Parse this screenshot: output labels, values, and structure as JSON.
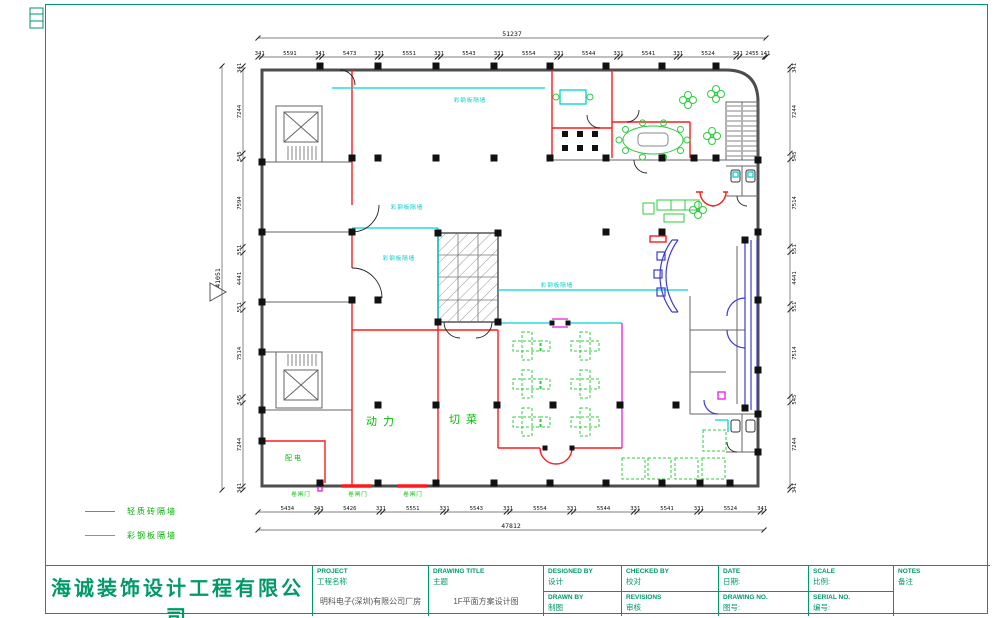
{
  "colors": {
    "sheet_border": "#009a66",
    "wall_gray": "#4d4d4d",
    "brick_wall_red": "#ff1a1a",
    "steel_wall_cyan": "#00d2d2",
    "furniture_green": "#00b400",
    "entrance_blue": "#3b3bd6",
    "accent_magenta": "#e61ae6",
    "company_green": "#009a66"
  },
  "legend": {
    "items": [
      {
        "label": "轻质砖隔墙",
        "color": "#ff1a1a"
      },
      {
        "label": "彩钢板隔墙",
        "color": "#00d2d2"
      }
    ]
  },
  "title_block": {
    "company_cn": "海诚装饰设计工程有限公司",
    "company_en": "SHENZHENSHI HAI CHENG DECORATION DESIGNENGINEERING CO.,LTD.",
    "fields": {
      "project": {
        "label_en": "PROJECT",
        "label_cn": "工程名称",
        "value": "明科电子(深圳)有限公司厂房"
      },
      "drawing_title": {
        "label_en": "DRAWING TITLE",
        "label_cn": "主题",
        "value": "1F平面方案设计图"
      },
      "designed_by": {
        "label_en": "DESIGNED BY",
        "label_cn": "设计",
        "value": ""
      },
      "drawn_by": {
        "label_en": "DRAWN BY",
        "label_cn": "制图",
        "value": ""
      },
      "checked_by": {
        "label_en": "CHECKED BY",
        "label_cn": "校对",
        "value": ""
      },
      "revisions": {
        "label_en": "REVISIONS",
        "label_cn": "审核",
        "value": ""
      },
      "date": {
        "label_en": "DATE",
        "label_cn": "日期:",
        "value": ""
      },
      "drawing_no": {
        "label_en": "DRAWING NO.",
        "label_cn": "图号:",
        "value": ""
      },
      "scale": {
        "label_en": "SCALE",
        "label_cn": "比例:",
        "value": ""
      },
      "serial_no": {
        "label_en": "SERIAL NO.",
        "label_cn": "编号:",
        "value": ""
      },
      "notes": {
        "label_en": "NOTES",
        "label_cn": "备注",
        "value": ""
      }
    }
  },
  "dim_rows": [
    {
      "name": "top-total",
      "orient": "h",
      "x1": 258,
      "x2": 766,
      "y": 38,
      "cls": "big",
      "labels": [
        "51237"
      ]
    },
    {
      "name": "top-segments",
      "orient": "h",
      "x1": 258,
      "x2": 766,
      "y": 57,
      "labels": [
        "341",
        "5591",
        "341",
        "5473",
        "331",
        "5551",
        "331",
        "5543",
        "331",
        "5554",
        "331",
        "5544",
        "331",
        "5541",
        "331",
        "5524",
        "341",
        "2455",
        "141"
      ]
    },
    {
      "name": "bottom-segments",
      "orient": "h",
      "x1": 258,
      "x2": 764,
      "y": 512,
      "labels": [
        "5434",
        "343",
        "5426",
        "331",
        "5551",
        "331",
        "5543",
        "331",
        "5554",
        "331",
        "5544",
        "331",
        "5541",
        "331",
        "5524",
        "341"
      ]
    },
    {
      "name": "bottom-total",
      "orient": "h",
      "x1": 258,
      "x2": 764,
      "y": 530,
      "cls": "big",
      "labels": [
        "47812"
      ]
    },
    {
      "name": "left-segments",
      "orient": "v",
      "x": 243,
      "y1": 66,
      "y2": 490,
      "toff": -2,
      "labels": [
        "341",
        "7244",
        "545",
        "7594",
        "551",
        "4441",
        "551",
        "7514",
        "545",
        "7244",
        "341"
      ]
    },
    {
      "name": "left-total",
      "orient": "v",
      "x": 222,
      "y1": 66,
      "y2": 490,
      "toff": -2,
      "cls": "big",
      "labels": [
        "41051"
      ]
    },
    {
      "name": "right-segments",
      "orient": "v",
      "x": 790,
      "y1": 66,
      "y2": 490,
      "toff": 6,
      "labels": [
        "341",
        "7244",
        "545",
        "7514",
        "551",
        "4441",
        "551",
        "7514",
        "545",
        "7244",
        "341"
      ]
    }
  ],
  "annotations": [
    {
      "name": "room-label-power",
      "text": "动力",
      "x": 383,
      "y": 421,
      "color": "#00c000",
      "fs": 11,
      "ls": 6
    },
    {
      "name": "room-label-cutting",
      "text": "切菜",
      "x": 466,
      "y": 419,
      "color": "#00c000",
      "fs": 11,
      "ls": 6
    },
    {
      "name": "room-label-distribution",
      "text": "配电",
      "x": 294,
      "y": 458,
      "color": "#00c000",
      "fs": 7,
      "ls": 2
    },
    {
      "name": "shutter-label",
      "text": "卷闸门",
      "x": 301,
      "y": 494,
      "color": "#00c000",
      "fs": 5.5,
      "ls": 1
    },
    {
      "name": "shutter-label",
      "text": "卷闸门",
      "x": 358,
      "y": 494,
      "color": "#00c000",
      "fs": 5.5,
      "ls": 1
    },
    {
      "name": "shutter-label",
      "text": "卷闸门",
      "x": 413,
      "y": 494,
      "color": "#00c000",
      "fs": 5.5,
      "ls": 1
    },
    {
      "name": "steel-wall-label",
      "text": "彩钢板隔墙",
      "x": 470,
      "y": 100,
      "color": "#00cccc",
      "fs": 5.5,
      "ls": 1
    },
    {
      "name": "steel-wall-label",
      "text": "彩钢板隔墙",
      "x": 407,
      "y": 207,
      "color": "#00cccc",
      "fs": 5.5,
      "ls": 1
    },
    {
      "name": "steel-wall-label",
      "text": "彩钢板隔墙",
      "x": 399,
      "y": 258,
      "color": "#00cccc",
      "fs": 5.5,
      "ls": 1
    },
    {
      "name": "steel-wall-label",
      "text": "彩钢板隔墙",
      "x": 557,
      "y": 285,
      "color": "#00cccc",
      "fs": 5.5,
      "ls": 1
    }
  ]
}
